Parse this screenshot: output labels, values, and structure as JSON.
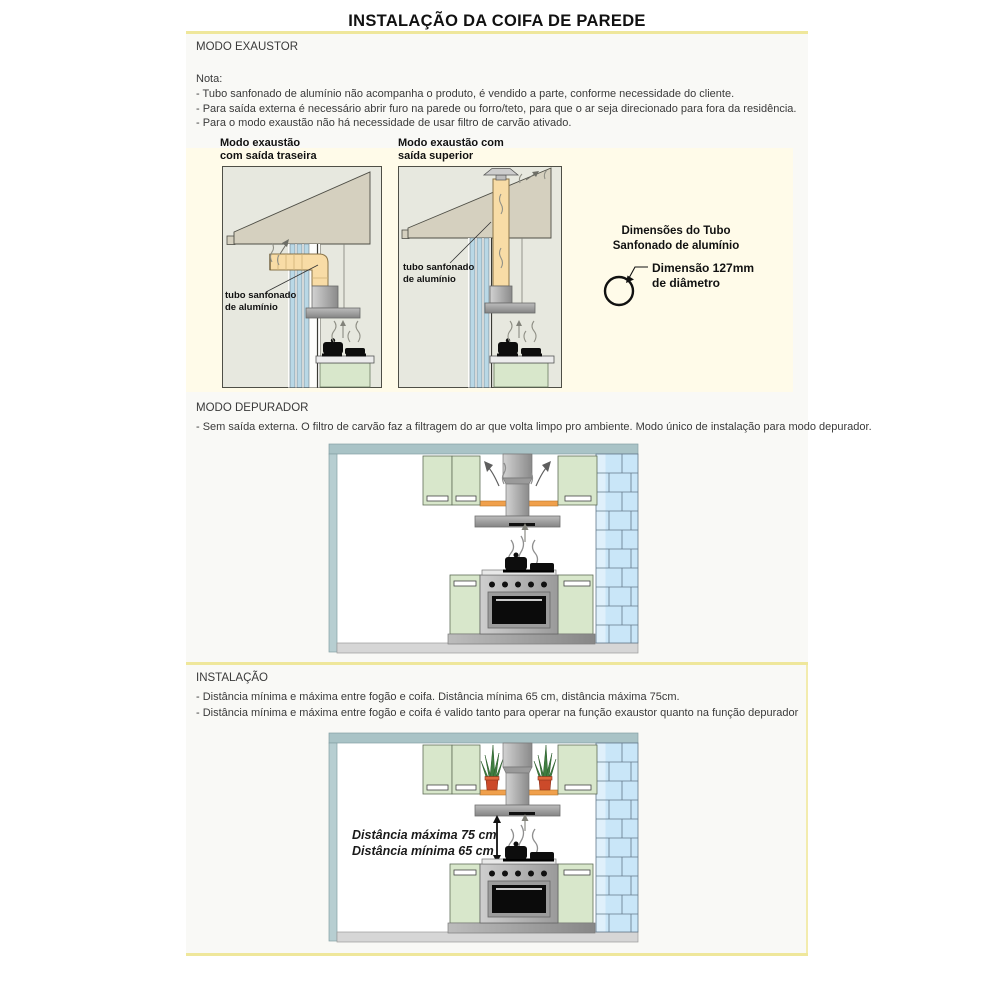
{
  "title": "INSTALAÇÃO DA COIFA DE PAREDE",
  "exaustor": {
    "heading": "MODO EXAUSTOR",
    "nota": "Nota:",
    "bullets": [
      "- Tubo sanfonado de alumínio não acompanha o produto, é vendido a parte, conforme necessidade do cliente.",
      "- Para saída externa é necessário abrir furo na parede ou forro/teto, para que o ar seja direcionado para fora da residência.",
      "- Para o modo exaustão não há necessidade de usar filtro de carvão ativado."
    ],
    "diagram_rear": {
      "label_line1": "Modo exaustão",
      "label_line2": "com saída traseira"
    },
    "diagram_top": {
      "label_line1": "Modo exaustão com",
      "label_line2": "saída superior"
    },
    "tube_label_line1": "tubo sanfonado",
    "tube_label_line2": "de alumínio",
    "dimensions": {
      "title_line1": "Dimensões do Tubo",
      "title_line2": "Sanfonado de alumínio",
      "note_line1": "Dimensão 127mm",
      "note_line2": "de diâmetro"
    }
  },
  "depurador": {
    "heading": "MODO DEPURADOR",
    "bullets": [
      "- Sem saída externa. O filtro de carvão faz a filtragem do ar que volta limpo pro ambiente. Modo único de instalação para modo depurador."
    ]
  },
  "instalacao": {
    "heading": "INSTALAÇÃO",
    "bullets": [
      "- Distância mínima e máxima entre fogão e coifa. Distância mínima 65 cm, distância máxima 75cm.",
      "- Distância mínima e máxima entre fogão e coifa é valido tanto para operar na função exaustor quanto na função depurador"
    ],
    "distance_max": "Distância máxima 75 cm",
    "distance_min": "Distância mínima 65 cm"
  },
  "colors": {
    "accent_yellow": "#efe79b",
    "cream_panel": "#fffbe9",
    "panel_gray": "#f9f9f6",
    "diagram_bg": "#e7e8df",
    "roof_tan": "#d5d0bf",
    "duct_cream": "#f8dca6",
    "pipe_blue": "#b9d8e6",
    "cabinet_green": "#d8e7cb",
    "brick_blue": "#c9e6f8",
    "shelf_orange": "#f0a04c",
    "ceiling_teal": "#a9c3c6"
  }
}
